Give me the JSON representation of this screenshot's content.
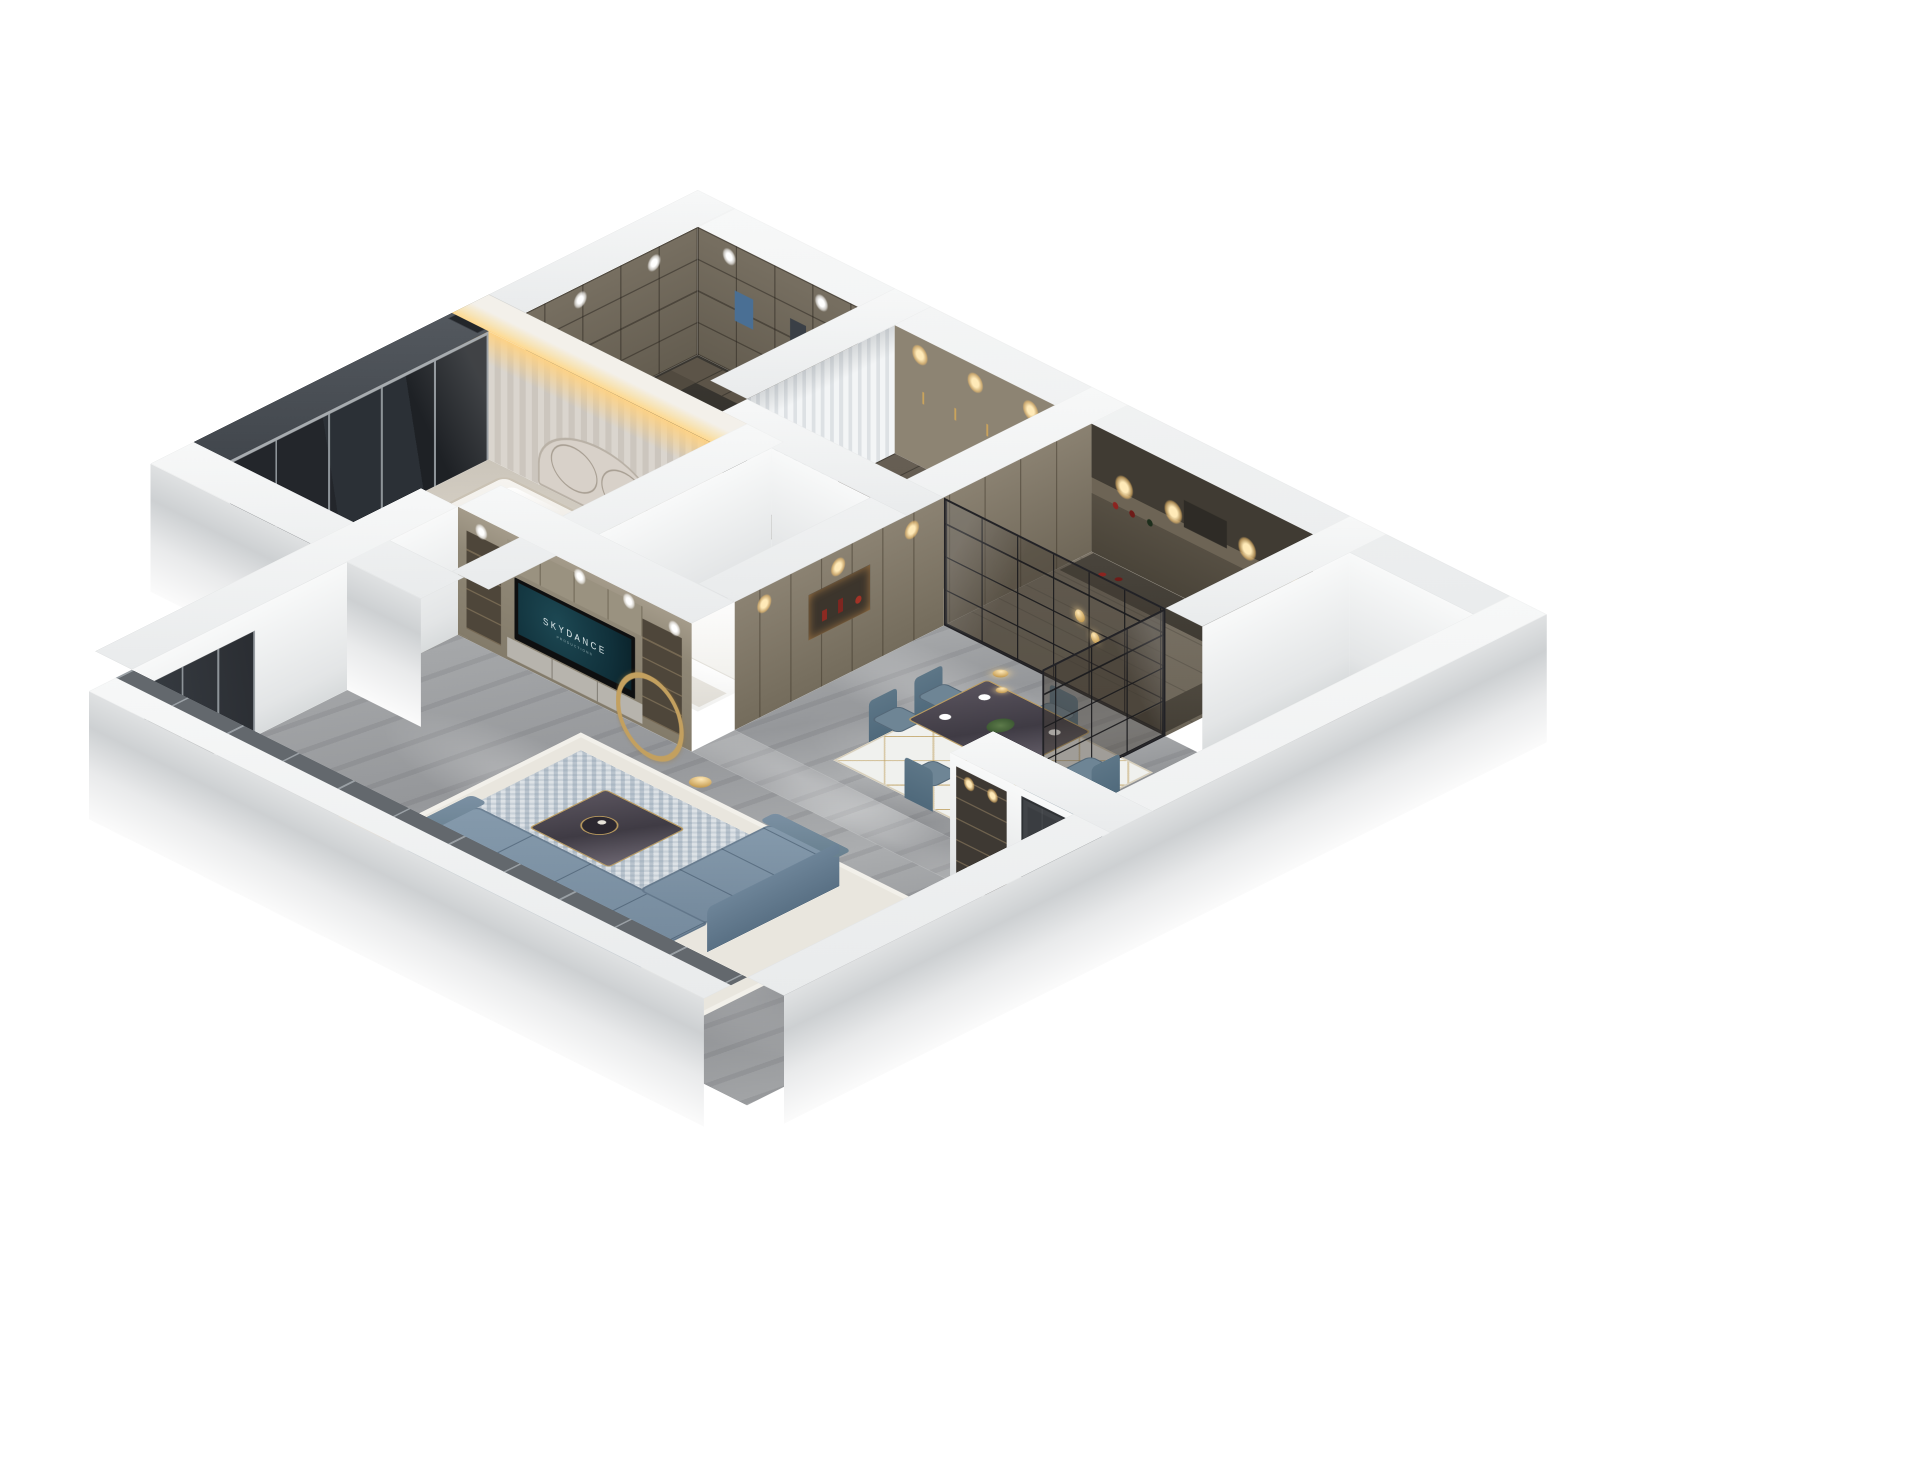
{
  "scene": {
    "type": "3d-isometric-floorplan-render",
    "background": "#ffffff",
    "description": "Dollhouse cutaway rendering of a furnished apartment viewed from above"
  },
  "tv": {
    "brand": "SKYDANCE",
    "subtitle": "PRODUCTIONS"
  },
  "rooms": [
    {
      "id": "master-bedroom",
      "label": "Master Bedroom"
    },
    {
      "id": "walk-in-closet",
      "label": "Walk-in Closet"
    },
    {
      "id": "entry-hall",
      "label": "Entry Hall"
    },
    {
      "id": "kitchen",
      "label": "Kitchen"
    },
    {
      "id": "dining-area",
      "label": "Dining Area"
    },
    {
      "id": "living-room",
      "label": "Living Room"
    },
    {
      "id": "second-bedroom",
      "label": "Second Bedroom"
    },
    {
      "id": "entry-corridor",
      "label": "Entry Corridor"
    }
  ],
  "furniture_counts": {
    "dining_chairs": 6,
    "sofas": 2,
    "beds": 2,
    "tv_screens": 1
  },
  "palette": {
    "background": "#ffffff",
    "wall_white": "#f2f3f4",
    "wall_shadow": "#cdd0d2",
    "marble_floor": "#9fa1a3",
    "cabinet_tan": "#8d8473",
    "cabinet_dark": "#403b33",
    "sofa_blue": "#7d93a6",
    "gold_accent": "#c3a05f",
    "glass_dark": "#2a2b2f",
    "warm_light": "#ffd98f",
    "curtain": "#eef0f2",
    "door_dark": "#3a3d41",
    "tv_screen_teal": "#16353d"
  }
}
